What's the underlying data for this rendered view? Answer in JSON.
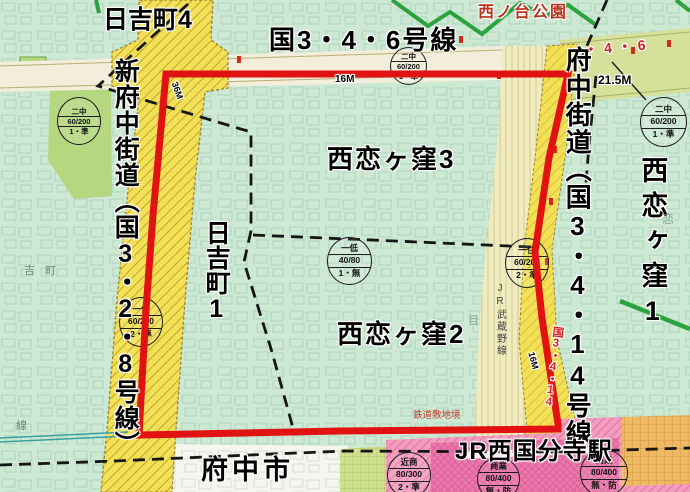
{
  "map": {
    "areas": {
      "hiyoshicho4": "日吉町4",
      "hiyoshicho1": "日吉町1",
      "nishikoigakubo3": "西恋ヶ窪3",
      "nishikoigakubo2": "西恋ヶ窪2",
      "nishikoigakubo1": "西恋ヶ窪1",
      "fuchushi": "府中市"
    },
    "roads": {
      "route_346": "国3・4・6号線",
      "shin_fuchu_kaido": "新府中街道︵国3・2・8号線︶",
      "fuchu_kaido": "府中街道︵国3・4・14号線",
      "route_3414_marker": "国3・4・14",
      "route_46_marker": "・4・6",
      "width_21_5m": "21.5M",
      "width_16m_top": "16M",
      "width_16m_rail": "16M",
      "width_36m": "36M"
    },
    "landmarks": {
      "station": "JR西国分寺駅",
      "park": "西ノ台公園",
      "jr_line": "JR武蔵野線",
      "rail_site_boundary": "鉄道敷地境",
      "base_text_yoshimachi": "吉町",
      "base_text_sen": "線",
      "base_text_koi": "恋",
      "base_text_me": "目"
    },
    "zoning_circles": [
      {
        "top": "二中",
        "mid": "60/200",
        "bottom": "1・準"
      },
      {
        "top": "二中",
        "mid": "60/200",
        "bottom": "1・準"
      },
      {
        "top": "二中",
        "mid": "60/200",
        "bottom": "1・準"
      },
      {
        "top": "一低",
        "mid": "40/80",
        "bottom": "1・無"
      },
      {
        "top": "一住",
        "mid": "60/200",
        "bottom": "2・準"
      },
      {
        "top": "一住",
        "mid": "60/200",
        "bottom": "2・準"
      },
      {
        "top": "近商",
        "mid": "80/300",
        "bottom": "2・準"
      },
      {
        "top": "商業",
        "mid": "80/400",
        "bottom": "無・防"
      },
      {
        "top": "商業",
        "mid": "80/400",
        "bottom": "無・防"
      }
    ],
    "colors": {
      "residential_mint": "#cde8d3",
      "park_green": "#b5d780",
      "road_yellow": "#f4e055",
      "road_cream": "#f2eedb",
      "band_yellowgreen": "#d7e09b",
      "railway_cream": "#f1ecc0",
      "commercial_pink": "#f19dbf",
      "station_magenta": "#e878ad",
      "neighborhood_orange": "#efb964",
      "lowrise_yellowgreen": "#cfe08c",
      "boundary_red": "#e11212",
      "admin_boundary_black": "#161616",
      "green_line": "#2ba23e",
      "rail_teal": "#38a1a1"
    }
  }
}
